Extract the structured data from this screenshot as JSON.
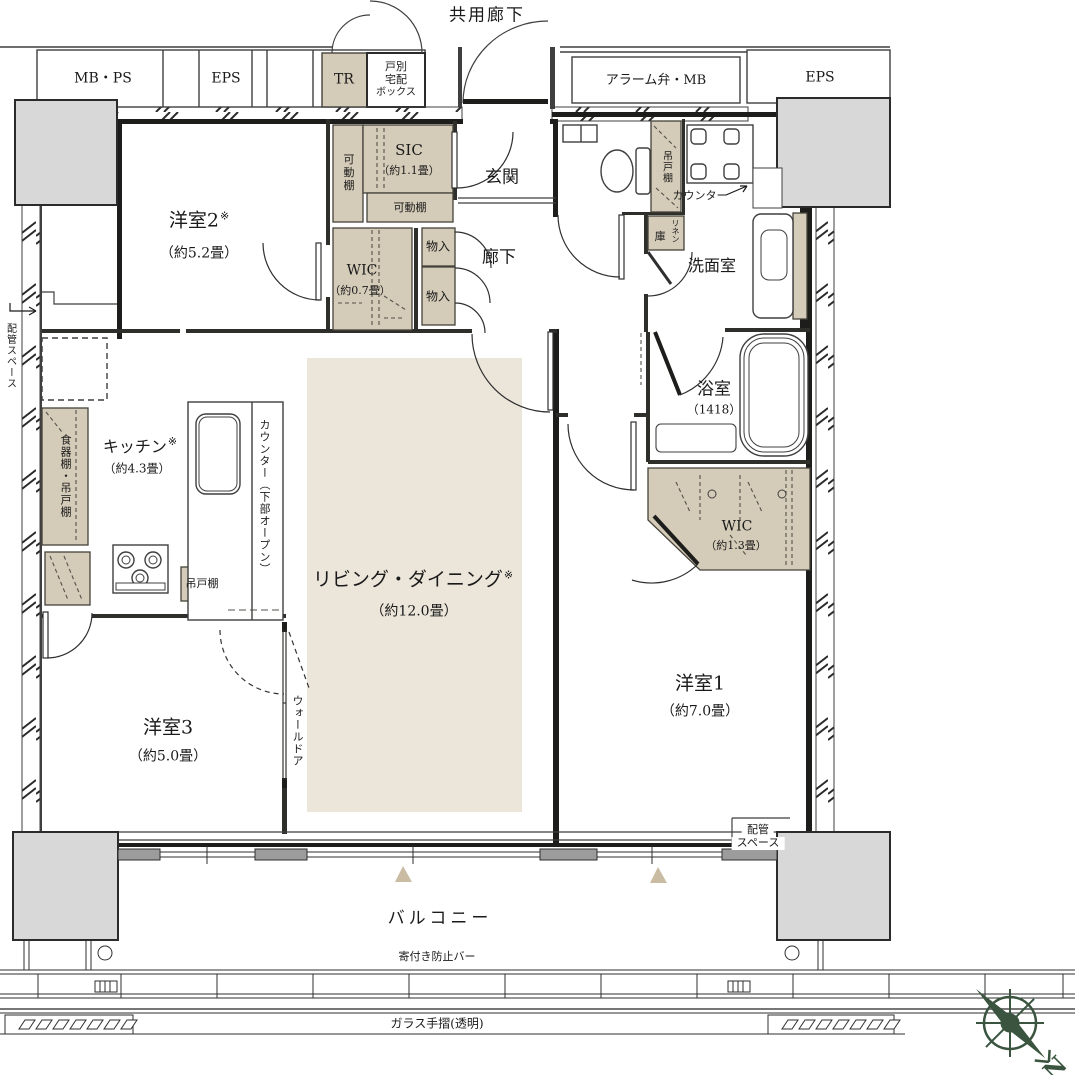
{
  "labels": {
    "kyoyo_roka": "共用廊下",
    "mb_ps": "MB・PS",
    "eps_left": "EPS",
    "tr": "TR",
    "kobetsu": [
      "戸別",
      "宅配",
      "ボックス"
    ],
    "alarm_mb": "アラーム弁・MB",
    "eps_right": "EPS",
    "yoshitsu2": {
      "name": "洋室2",
      "note": "※",
      "size": "（約5.2畳）"
    },
    "kado_tana_v": "可動棚",
    "sic": {
      "name": "SIC",
      "size": "（約1.1畳）"
    },
    "kado_tana_h": "可動棚",
    "genkan": "玄関",
    "wic07": {
      "name": "WIC",
      "size": "（約0.7畳）"
    },
    "mono_ire_1": "物入",
    "mono_ire_2": "物入",
    "roka": "廊下",
    "tsurido_dana_toilet": "吊戸棚",
    "counter_wash": "カウンター",
    "linen": {
      "kanji": "庫",
      "kana": "リネン"
    },
    "senmenshitsu": "洗面室",
    "yokushitsu": {
      "name": "浴室",
      "size": "（1418）"
    },
    "wic13": {
      "name": "WIC",
      "size": "（約1.3畳）"
    },
    "yoshitsu1": {
      "name": "洋室1",
      "size": "（約7.0畳）"
    },
    "kitchen": {
      "name": "キッチン",
      "note": "※",
      "size": "（約4.3畳）"
    },
    "shokkidana": "食器棚・吊戸棚",
    "counter_kitchen": "カウンター（下部オープン）",
    "tsurido_dana_kitchen": "吊戸棚",
    "ld": {
      "name": "リビング・ダイニング",
      "note": "※",
      "size": "（約12.0畳）"
    },
    "yoshitsu3": {
      "name": "洋室3",
      "size": "（約5.0畳）"
    },
    "wall_door": "ウォールドア",
    "haikan_left": "配管スペース",
    "haikan_right": [
      "配管",
      "スペース"
    ],
    "balcony": "バルコニー",
    "yoritsuki": "寄付き防止バー",
    "glass_tesuri": "ガラス手摺(透明)",
    "compass_n": "N"
  },
  "colors": {
    "storage_tan": "#D4CBB8",
    "ld_floor": "#EBE5DA",
    "column_gray": "#D8D8D8",
    "wall": "#1D1D1B",
    "triangle_beige": "#C9BCA2",
    "compass_green": "#3A543F"
  }
}
